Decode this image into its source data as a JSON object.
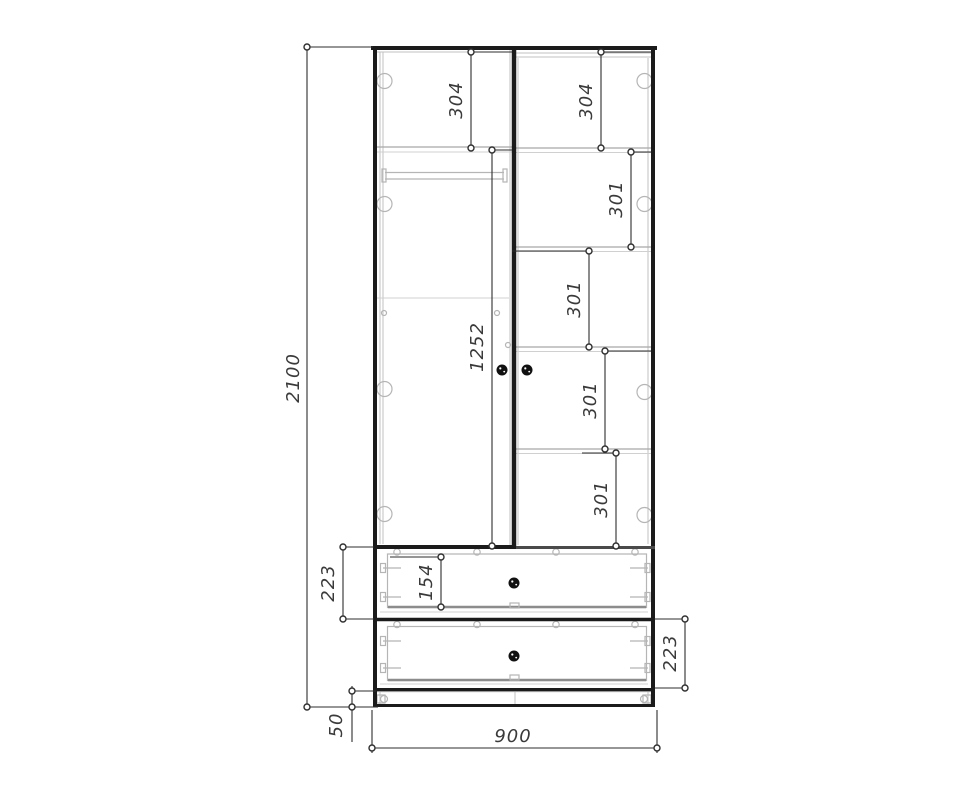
{
  "drawing": {
    "name": "wardrobe-front-view-dimensioned-drawing",
    "units": "mm",
    "colors": {
      "line": "#1b1b1b",
      "detail_gray": "#b5b5b5",
      "dimension": "#3a3a3a",
      "background": "#ffffff",
      "handle": "#111111"
    },
    "dims": {
      "overall_height": "2100",
      "overall_width": "900",
      "plinth_height": "50",
      "left_top_section": "304",
      "right_top_section": "304",
      "right_section_1": "301",
      "right_section_2": "301",
      "right_section_3": "301",
      "right_section_4": "301",
      "left_inner_height": "1252",
      "upper_drawer_height": "223",
      "drawer_front_height": "154",
      "lower_drawer_height": "223"
    }
  }
}
